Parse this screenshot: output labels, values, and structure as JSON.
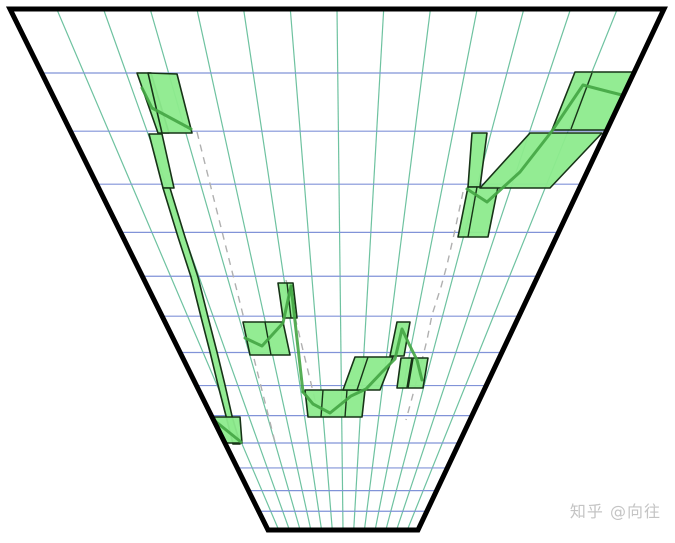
{
  "canvas": {
    "width": 675,
    "height": 543,
    "background": "#ffffff"
  },
  "watermark": {
    "text": "知乎 @向往",
    "color": "#c4c4c4"
  },
  "chart_data": {
    "type": "perspective_candlestick_funnel",
    "title": "",
    "xlabel": "",
    "ylabel": "",
    "axis_labels_visible": false,
    "description": "Price-range band chart drawn in converging perspective: wide at top (near), narrow at bottom (far). Price path falls from upper-left to a low mid-bottom region then rises to upper-right.",
    "frame": {
      "top_left": [
        10,
        9
      ],
      "top_right": [
        664,
        9
      ],
      "bottom_right": [
        418,
        530
      ],
      "bottom_left": [
        268,
        530
      ],
      "stroke": "#000000",
      "stroke_width": 5
    },
    "grid": {
      "h_line_count": 13,
      "h_perspective_ratio": 0.91,
      "h_color": "#8193d8",
      "v_line_count": 13,
      "v_color": "#6ec2a0",
      "line_width": 1.2
    },
    "colors": {
      "candle_fill": "#8deb8d",
      "candle_stroke": "#173317",
      "price_line": "#44a544",
      "trend_dashed": "#b0b0b0"
    },
    "candles": [
      {
        "name": "left-top-narrow",
        "points": [
          [
            137,
            73
          ],
          [
            151,
            73
          ],
          [
            169,
            133
          ],
          [
            158,
            133
          ]
        ]
      },
      {
        "name": "left-top-big",
        "points": [
          [
            148,
            73
          ],
          [
            177,
            74
          ],
          [
            192,
            133
          ],
          [
            162,
            133
          ]
        ]
      },
      {
        "name": "left-sliver",
        "points": [
          [
            149,
            134
          ],
          [
            162,
            134
          ],
          [
            174,
            188
          ],
          [
            163,
            188
          ]
        ]
      },
      {
        "name": "left-fall-streak",
        "points": [
          [
            163,
            188
          ],
          [
            178,
            237
          ],
          [
            191,
            277
          ],
          [
            201,
            317
          ],
          [
            210,
            352
          ],
          [
            218,
            385
          ],
          [
            226,
            416
          ],
          [
            233,
            444
          ],
          [
            240,
            444
          ],
          [
            232,
            416
          ],
          [
            225,
            385
          ],
          [
            217,
            352
          ],
          [
            208,
            317
          ],
          [
            198,
            277
          ],
          [
            185,
            237
          ],
          [
            170,
            188
          ]
        ]
      },
      {
        "name": "left-bottom",
        "points": [
          [
            213,
            417
          ],
          [
            240,
            417
          ],
          [
            242,
            443
          ],
          [
            217,
            443
          ]
        ]
      },
      {
        "name": "mid-left-pair",
        "points": [
          [
            243,
            322
          ],
          [
            283,
            322
          ],
          [
            290,
            355
          ],
          [
            250,
            355
          ]
        ],
        "inner_lines": [
          [
            [
              265,
              322
            ],
            [
              271,
              355
            ]
          ]
        ]
      },
      {
        "name": "mid-small-upper",
        "points": [
          [
            278,
            283
          ],
          [
            293,
            283
          ],
          [
            297,
            318
          ],
          [
            283,
            318
          ]
        ],
        "inner_lines": [
          [
            [
              287,
              283
            ],
            [
              291,
              318
            ]
          ]
        ]
      },
      {
        "name": "bottom-triple",
        "points": [
          [
            305,
            390
          ],
          [
            365,
            390
          ],
          [
            362,
            417
          ],
          [
            308,
            417
          ]
        ],
        "inner_lines": [
          [
            [
              323,
              390
            ],
            [
              321,
              417
            ]
          ],
          [
            [
              347,
              390
            ],
            [
              345,
              417
            ]
          ]
        ]
      },
      {
        "name": "bottom-rise-pair",
        "points": [
          [
            355,
            357
          ],
          [
            393,
            357
          ],
          [
            380,
            390
          ],
          [
            343,
            390
          ]
        ],
        "inner_lines": [
          [
            [
              368,
              357
            ],
            [
              357,
              390
            ]
          ]
        ]
      },
      {
        "name": "mid-tall",
        "points": [
          [
            397,
            322
          ],
          [
            410,
            322
          ],
          [
            404,
            356
          ],
          [
            390,
            356
          ]
        ]
      },
      {
        "name": "mid-right-a",
        "points": [
          [
            401,
            358
          ],
          [
            412,
            358
          ],
          [
            407,
            388
          ],
          [
            397,
            388
          ]
        ]
      },
      {
        "name": "mid-right-b",
        "points": [
          [
            413,
            358
          ],
          [
            428,
            358
          ],
          [
            423,
            388
          ],
          [
            408,
            388
          ]
        ]
      },
      {
        "name": "right-thin",
        "points": [
          [
            472,
            133
          ],
          [
            487,
            133
          ],
          [
            480,
            187
          ],
          [
            468,
            187
          ]
        ]
      },
      {
        "name": "right-step-low",
        "points": [
          [
            468,
            187
          ],
          [
            498,
            187
          ],
          [
            488,
            237
          ],
          [
            458,
            237
          ]
        ],
        "inner_lines": [
          [
            [
              477,
              187
            ],
            [
              468,
              237
            ]
          ]
        ]
      },
      {
        "name": "right-band",
        "points": [
          [
            530,
            133
          ],
          [
            602,
            133
          ],
          [
            550,
            188
          ],
          [
            480,
            188
          ]
        ]
      },
      {
        "name": "right-top",
        "points": [
          [
            575,
            72
          ],
          [
            635,
            72
          ],
          [
            608,
            130
          ],
          [
            552,
            130
          ]
        ],
        "inner_lines": [
          [
            [
              592,
              73
            ],
            [
              571,
              129
            ]
          ]
        ]
      }
    ],
    "price_line_segments": [
      [
        [
          142,
          88
        ],
        [
          152,
          108
        ],
        [
          191,
          129
        ]
      ],
      [
        [
          215,
          421
        ],
        [
          241,
          442
        ]
      ],
      [
        [
          245,
          338
        ],
        [
          262,
          346
        ],
        [
          283,
          323
        ],
        [
          291,
          286
        ]
      ],
      [
        [
          291,
          286
        ],
        [
          303,
          392
        ]
      ],
      [
        [
          303,
          392
        ],
        [
          313,
          404
        ],
        [
          330,
          413
        ],
        [
          351,
          396
        ],
        [
          366,
          389
        ],
        [
          383,
          371
        ],
        [
          395,
          359
        ],
        [
          402,
          329
        ],
        [
          409,
          344
        ],
        [
          417,
          360
        ],
        [
          422,
          380
        ]
      ],
      [
        [
          467,
          189
        ],
        [
          487,
          202
        ],
        [
          520,
          172
        ],
        [
          552,
          131
        ],
        [
          583,
          85
        ],
        [
          610,
          92
        ],
        [
          630,
          97
        ]
      ]
    ],
    "trend_lines_dashed": [
      [
        [
          197,
          132
        ],
        [
          276,
          446
        ]
      ],
      [
        [
          286,
          280
        ],
        [
          316,
          404
        ]
      ],
      [
        [
          463,
          192
        ],
        [
          455,
          230
        ],
        [
          447,
          265
        ],
        [
          441,
          287
        ],
        [
          432,
          315
        ],
        [
          427,
          340
        ],
        [
          420,
          368
        ],
        [
          412,
          398
        ],
        [
          406,
          420
        ]
      ]
    ]
  }
}
